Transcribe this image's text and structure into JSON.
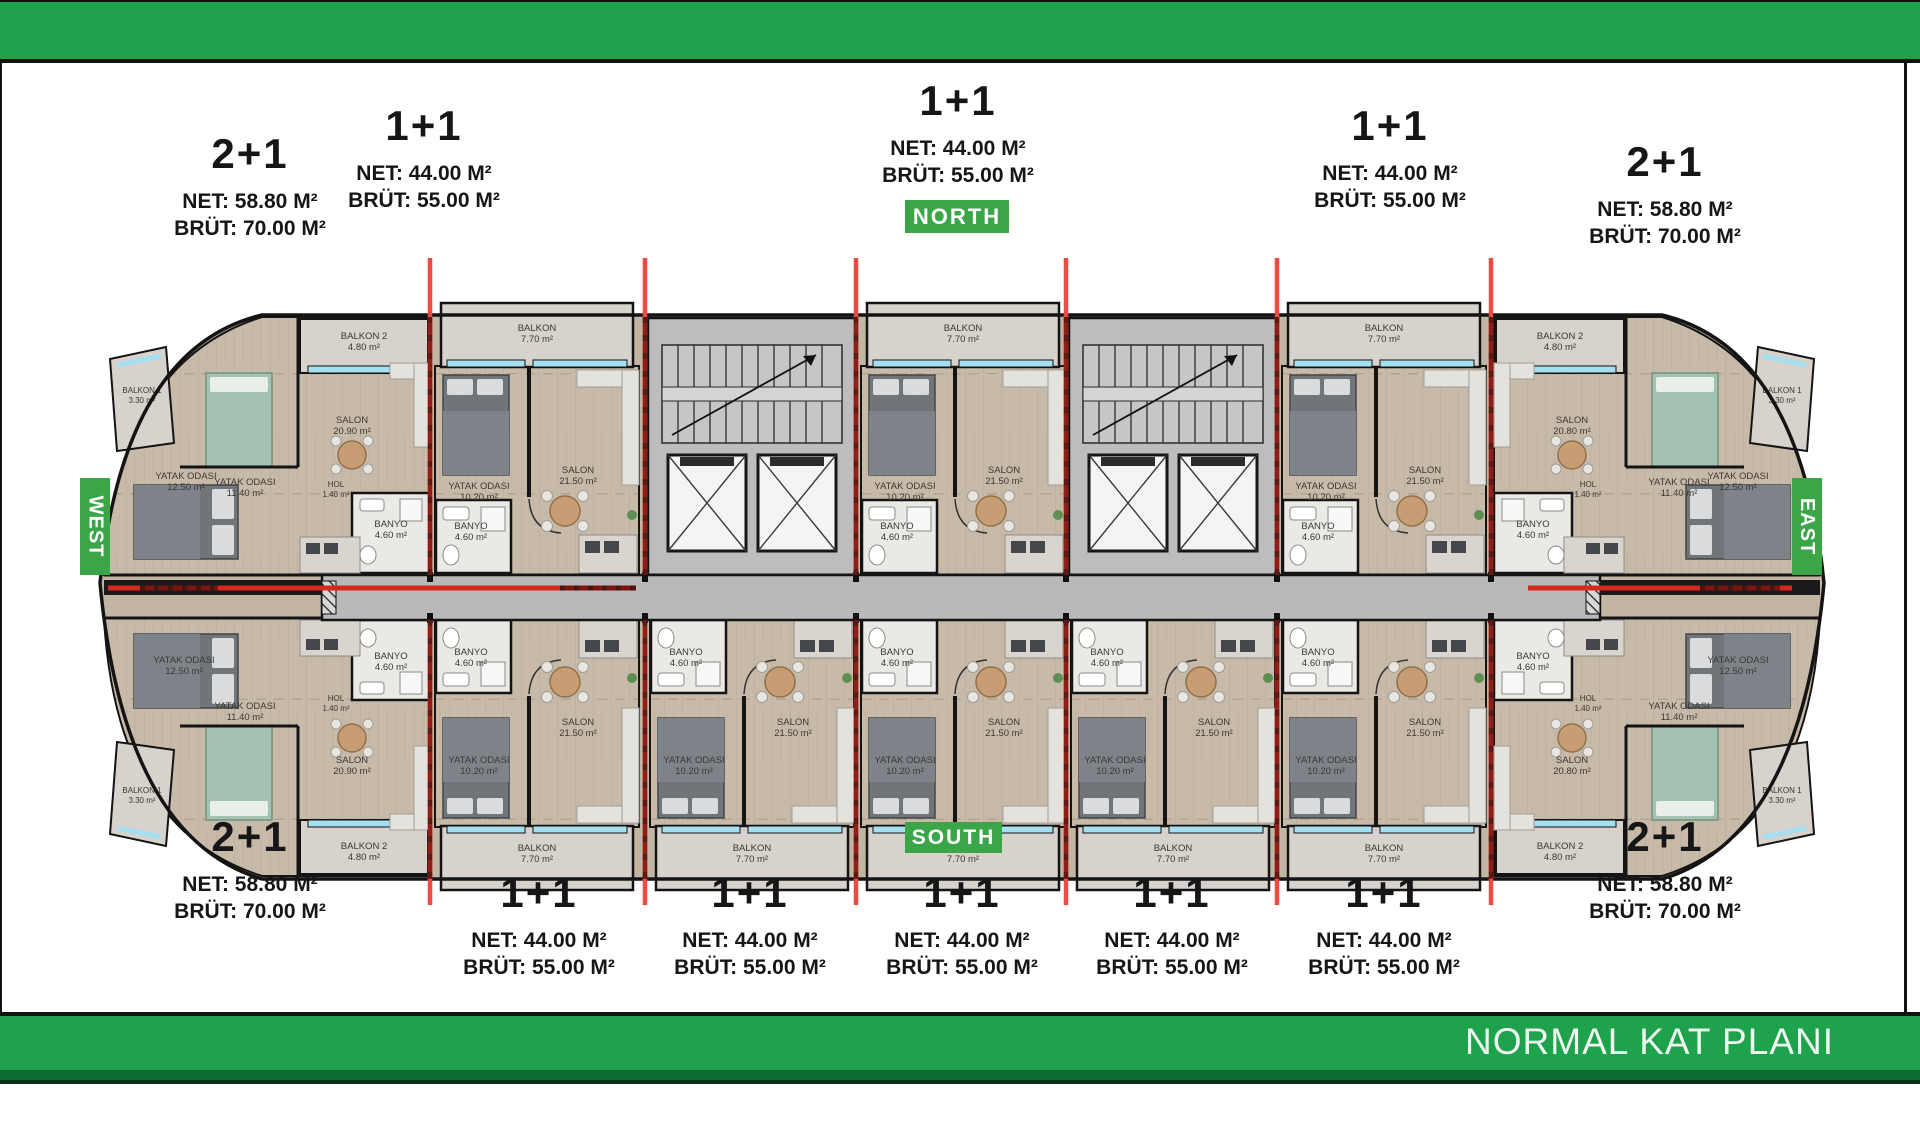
{
  "page": {
    "title": "NORMAL KAT PLANI"
  },
  "directions": {
    "north": "NORTH",
    "south": "SOUTH",
    "east": "EAST",
    "west": "WEST"
  },
  "colors": {
    "bar_green": "#1fa24c",
    "badge_green": "#3aa648",
    "dark_green_strip": "#0d6a31",
    "red_line": "#ea4b42",
    "dark_red": "#8f1e17",
    "wall_black": "#141414",
    "corridor_gray": "#b9b9b9",
    "floor_wood": "#c7baa9",
    "balcony_gray": "#d7d2cb",
    "window_cyan": "#a6dff0"
  },
  "top_units": [
    {
      "type": "2+1",
      "net": "NET: 58.80 M²",
      "brut": "BRÜT: 70.00 M²"
    },
    {
      "type": "1+1",
      "net": "NET: 44.00 M²",
      "brut": "BRÜT: 55.00 M²"
    },
    {
      "type": "1+1",
      "net": "NET: 44.00 M²",
      "brut": "BRÜT: 55.00 M²"
    },
    {
      "type": "1+1",
      "net": "NET: 44.00 M²",
      "brut": "BRÜT: 55.00 M²"
    },
    {
      "type": "2+1",
      "net": "NET: 58.80 M²",
      "brut": "BRÜT: 70.00 M²"
    }
  ],
  "bottom_units": [
    {
      "type": "2+1",
      "net": "NET: 58.80 M²",
      "brut": "BRÜT: 70.00 M²"
    },
    {
      "type": "1+1",
      "net": "NET: 44.00 M²",
      "brut": "BRÜT: 55.00 M²"
    },
    {
      "type": "1+1",
      "net": "NET: 44.00 M²",
      "brut": "BRÜT: 55.00 M²"
    },
    {
      "type": "1+1",
      "net": "NET: 44.00 M²",
      "brut": "BRÜT: 55.00 M²"
    },
    {
      "type": "1+1",
      "net": "NET: 44.00 M²",
      "brut": "BRÜT: 55.00 M²"
    },
    {
      "type": "1+1",
      "net": "NET: 44.00 M²",
      "brut": "BRÜT: 55.00 M²"
    },
    {
      "type": "2+1",
      "net": "NET: 58.80 M²",
      "brut": "BRÜT: 70.00 M²"
    }
  ],
  "plan": {
    "module": {
      "balkon": "BALKON",
      "balkon_area": "7.70 m²",
      "salon": "SALON",
      "salon_area": "21.50 m²",
      "yatak": "YATAK ODASI",
      "yatak_area": "10.20 m²",
      "banyo": "BANYO",
      "banyo_area": "4.60 m²"
    },
    "end_unit": {
      "balkon1": "BALKON 1",
      "balkon1_area": "3.30 m²",
      "balkon2": "BALKON 2",
      "balkon2_area": "4.80 m²",
      "yatak1": "YATAK ODASI",
      "yatak1_area": "11.40 m²",
      "yatak2": "YATAK ODASI",
      "yatak2_area": "12.50 m²",
      "banyo": "BANYO",
      "banyo_area": "4.60 m²",
      "hol": "HOL",
      "hol_area": "1.40 m²",
      "salon": "SALON",
      "salon_area_left": "20.90 m²",
      "salon_area_right": "20.80 m²"
    }
  }
}
